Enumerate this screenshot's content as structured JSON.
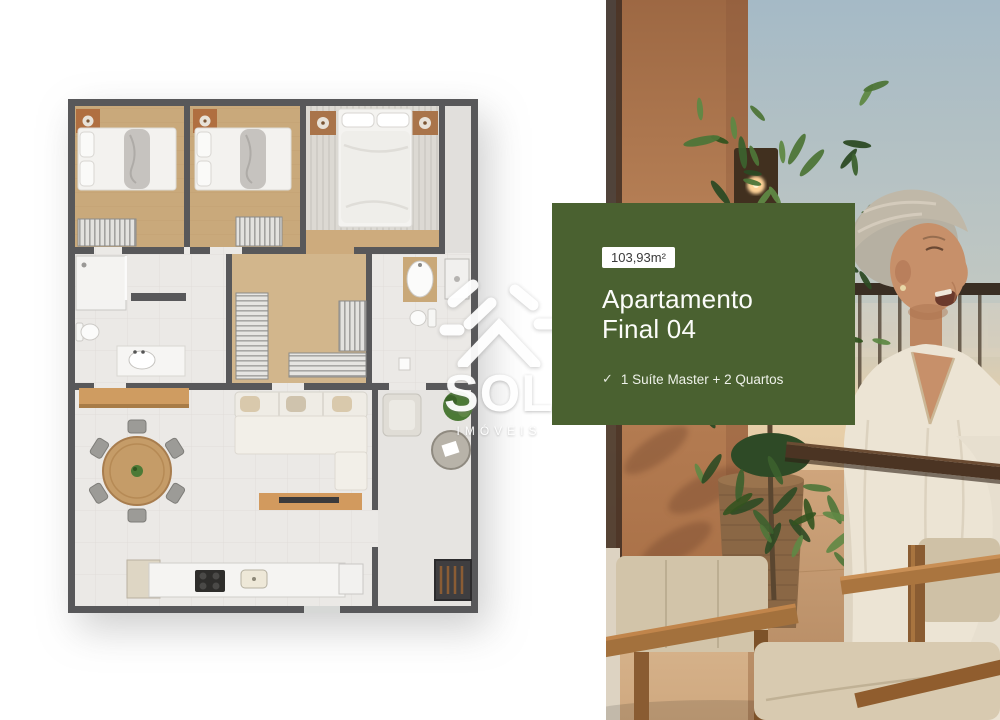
{
  "page": {
    "background_color": "#ffffff"
  },
  "info_card": {
    "background_color": "#4a6130",
    "area_badge": "103,93m²",
    "title_line1": "Apartamento",
    "title_line2": "Final 04",
    "check_icon": "✓",
    "feature": "1 Suíte Master + 2 Quartos",
    "badge_bg": "#ffffff",
    "badge_text_color": "#3a3a3a",
    "text_color": "#ffffff"
  },
  "watermark": {
    "brand": "SOL",
    "subtitle": "IMÓVEIS",
    "icon": "sun-over-roof-logo-icon",
    "color": "#ffffff"
  },
  "floor_plan": {
    "name": "apartment-top-view-floor-plan",
    "colors": {
      "wall": "#58585a",
      "wood_floor": "#c9a97b",
      "tile_floor": "#ebe9e6",
      "furniture_wood": "#cf9c61",
      "plant_green": "#4c7a36"
    }
  },
  "photo": {
    "name": "woman-laughing-on-balcony-at-sunset",
    "sky_top_color": "#a5bac6",
    "sky_horizon_color": "#e8d0aa",
    "wall_color": "#b57c4e",
    "plant_color": "#3c612e"
  }
}
